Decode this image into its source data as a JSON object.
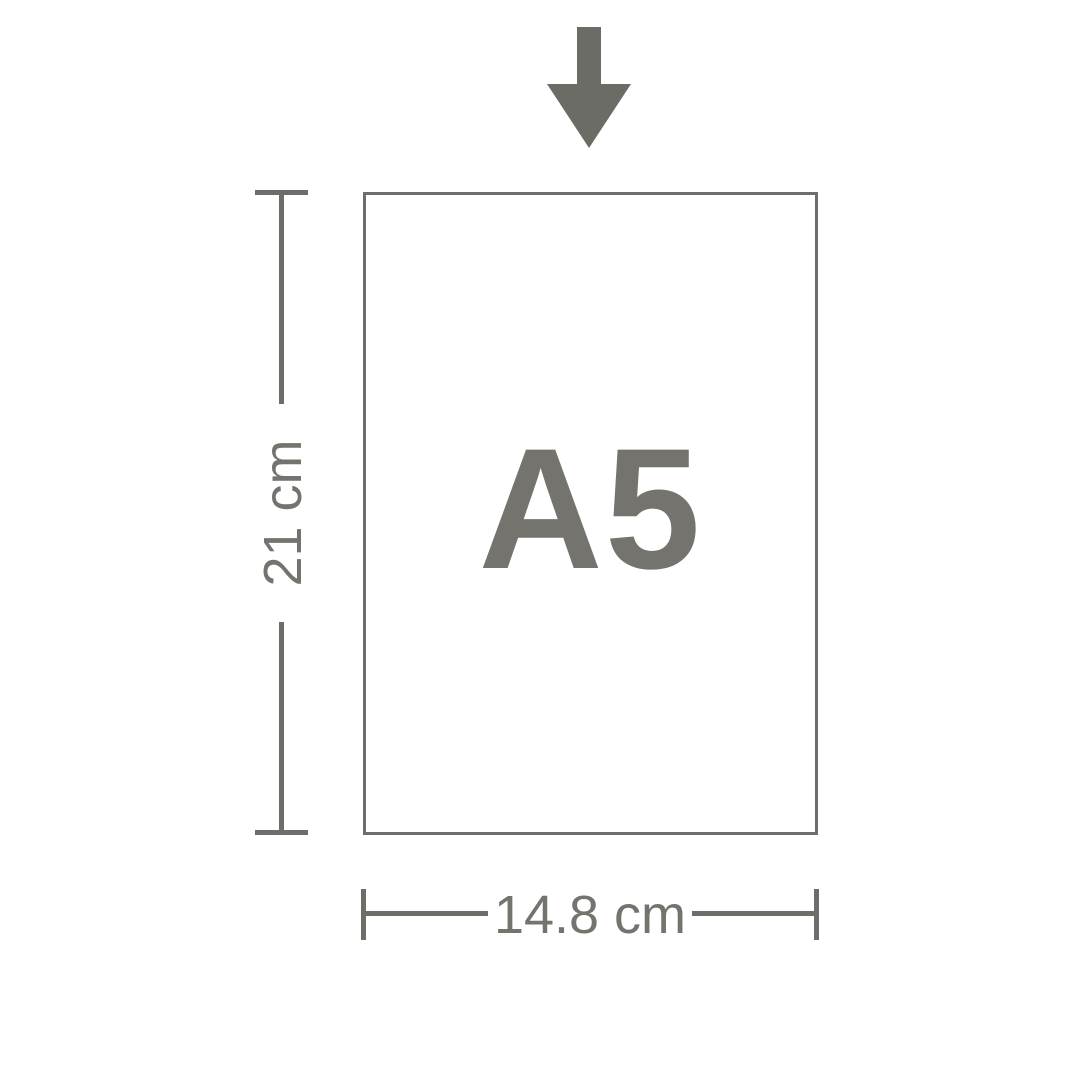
{
  "diagram": {
    "paper": {
      "label": "A5"
    },
    "dimensions": {
      "height": {
        "label": "21 cm"
      },
      "width": {
        "label": "14.8 cm"
      }
    },
    "icons": {
      "arrow": "arrow-down-icon"
    },
    "colors": {
      "line": "#6e6e68",
      "text": "#74736e",
      "arrow": "#6c6c66",
      "background": "#ffffff"
    }
  }
}
